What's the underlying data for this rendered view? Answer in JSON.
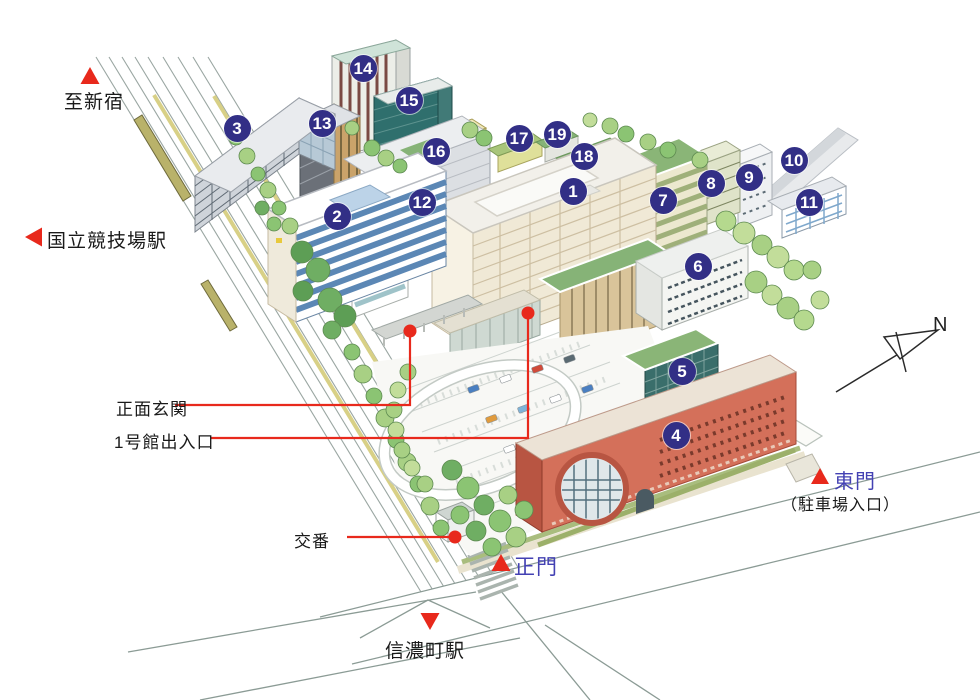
{
  "colors": {
    "badge": "#322f86",
    "accent_red": "#e8291c",
    "gate_blue": "#4341b3"
  },
  "labels": {
    "to_shinjuku": "至新宿",
    "kokuritsu_station": "国立競技場駅",
    "main_entrance": "正面玄関",
    "bldg1_entrance": "1号館出入口",
    "police_box": "交番",
    "main_gate": "正門",
    "east_gate": "東門",
    "east_gate_sub": "（駐車場入口）",
    "shinanomachi_station": "信濃町駅"
  },
  "compass": {
    "label": "N"
  },
  "markers": [
    {
      "number": "1",
      "x": 573,
      "y": 191
    },
    {
      "number": "2",
      "x": 337,
      "y": 216
    },
    {
      "number": "3",
      "x": 237,
      "y": 128
    },
    {
      "number": "4",
      "x": 676,
      "y": 435
    },
    {
      "number": "5",
      "x": 682,
      "y": 371
    },
    {
      "number": "6",
      "x": 698,
      "y": 266
    },
    {
      "number": "7",
      "x": 663,
      "y": 200
    },
    {
      "number": "8",
      "x": 711,
      "y": 183
    },
    {
      "number": "9",
      "x": 749,
      "y": 177
    },
    {
      "number": "10",
      "x": 794,
      "y": 160
    },
    {
      "number": "11",
      "x": 809,
      "y": 202
    },
    {
      "number": "12",
      "x": 422,
      "y": 202
    },
    {
      "number": "13",
      "x": 322,
      "y": 123
    },
    {
      "number": "14",
      "x": 363,
      "y": 68
    },
    {
      "number": "15",
      "x": 409,
      "y": 100
    },
    {
      "number": "16",
      "x": 436,
      "y": 151
    },
    {
      "number": "17",
      "x": 519,
      "y": 138
    },
    {
      "number": "18",
      "x": 584,
      "y": 156
    },
    {
      "number": "19",
      "x": 557,
      "y": 134
    }
  ]
}
